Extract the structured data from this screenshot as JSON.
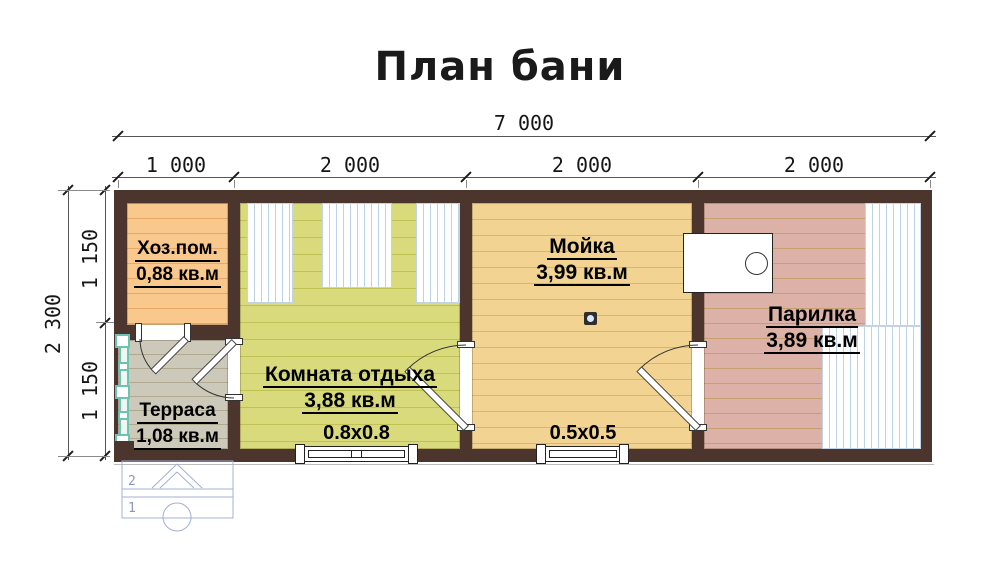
{
  "title": "План бани",
  "dims": {
    "top_total": "7 000",
    "top_segments": [
      "1 000",
      "2 000",
      "2 000",
      "2 000"
    ],
    "left_total": "2 300",
    "left_segments": [
      "1 150",
      "1 150"
    ]
  },
  "rooms": {
    "hozpom": {
      "name": "Хоз.пом.",
      "area": "0,88 кв.м",
      "color": "#f8c88d"
    },
    "komnata": {
      "name": "Комната отдыха",
      "area": "3,88 кв.м",
      "color": "#d8da7c"
    },
    "moyka": {
      "name": "Мойка",
      "area": "3,99 кв.м",
      "color": "#f2d391"
    },
    "parilka": {
      "name": "Парилка",
      "area": "3,89 кв.м",
      "color": "#dcb1a7"
    },
    "terrasa": {
      "name": "Терраса",
      "area": "1,08 кв.м",
      "color": "#ccc8ba"
    }
  },
  "windows": {
    "w1": "0.8x0.8",
    "w2": "0.5x0.5"
  },
  "steps": {
    "top": "2",
    "bottom": "1"
  },
  "colors": {
    "wall": "#4c352d",
    "bench_lines": "#bcd2e6",
    "railing": "#6cc4b0",
    "steps_outline": "#a3b0d6",
    "text": "#000000"
  }
}
